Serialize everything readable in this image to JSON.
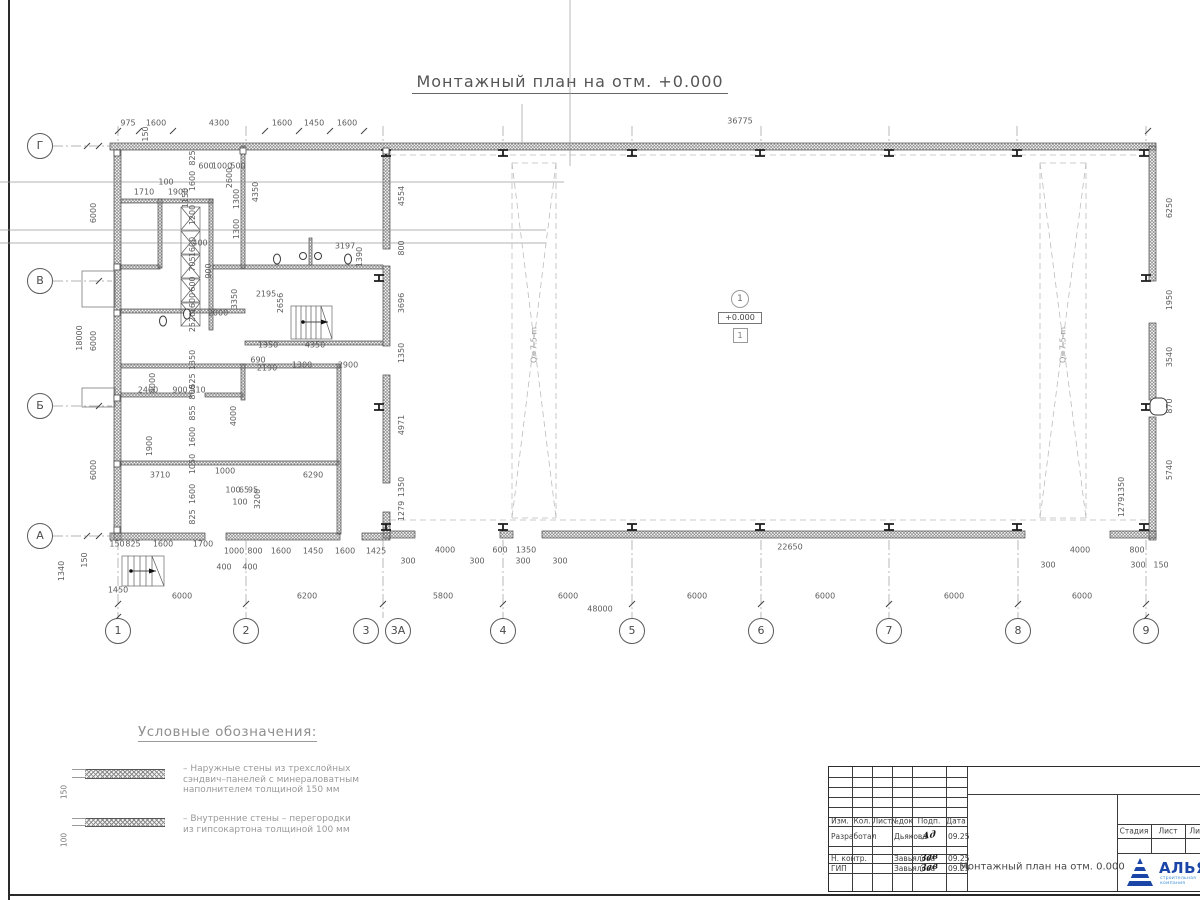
{
  "page": {
    "title": "Монтажный план на отм. +0.000"
  },
  "plan": {
    "axes_bottom": [
      {
        "label": "1",
        "x": 118
      },
      {
        "label": "2",
        "x": 246
      },
      {
        "label": "3",
        "x": 366
      },
      {
        "label": "3А",
        "x": 398
      },
      {
        "label": "4",
        "x": 503
      },
      {
        "label": "5",
        "x": 632
      },
      {
        "label": "6",
        "x": 761
      },
      {
        "label": "7",
        "x": 889
      },
      {
        "label": "8",
        "x": 1018
      },
      {
        "label": "9",
        "x": 1146
      }
    ],
    "axes_left": [
      {
        "label": "Г",
        "y": 146
      },
      {
        "label": "В",
        "y": 281
      },
      {
        "label": "Б",
        "y": 406
      },
      {
        "label": "А",
        "y": 536
      }
    ],
    "level_mark": {
      "axis_circle": "1",
      "elevation": "+0.000",
      "room_number": "1"
    },
    "crane_zones": [
      {
        "x": 534,
        "y": 345
      },
      {
        "x": 1063,
        "y": 345
      }
    ],
    "crane_label": "Q=7.5 m",
    "dims": [
      [
        "975",
        128,
        124
      ],
      [
        "1600",
        156,
        124
      ],
      [
        "4300",
        219,
        124
      ],
      [
        "1600",
        282,
        124
      ],
      [
        "1450",
        314,
        124
      ],
      [
        "1600",
        347,
        124
      ],
      [
        "36775",
        740,
        122
      ],
      [
        "150",
        146,
        134,
        1
      ],
      [
        "18000",
        80,
        338,
        1
      ],
      [
        "6000",
        94,
        213,
        1
      ],
      [
        "6000",
        94,
        341,
        1
      ],
      [
        "6000",
        94,
        470,
        1
      ],
      [
        "825",
        193,
        158,
        1
      ],
      [
        "1600",
        193,
        181,
        1
      ],
      [
        "1200",
        193,
        215,
        1
      ],
      [
        "1600",
        193,
        247,
        1
      ],
      [
        "705",
        193,
        264,
        1
      ],
      [
        "600",
        193,
        284,
        1
      ],
      [
        "1600",
        193,
        303,
        1
      ],
      [
        "2520",
        193,
        322,
        1
      ],
      [
        "1350",
        193,
        360,
        1
      ],
      [
        "525",
        193,
        381,
        1
      ],
      [
        "800",
        193,
        392,
        1
      ],
      [
        "855",
        193,
        413,
        1
      ],
      [
        "1600",
        193,
        437,
        1
      ],
      [
        "1050",
        193,
        464,
        1
      ],
      [
        "1600",
        193,
        494,
        1
      ],
      [
        "825",
        193,
        517,
        1
      ],
      [
        "2600",
        230,
        178,
        1
      ],
      [
        "100",
        166,
        183
      ],
      [
        "1710",
        144,
        193
      ],
      [
        "1900",
        178,
        193
      ],
      [
        "1150",
        186,
        198,
        1
      ],
      [
        "600",
        206,
        167
      ],
      [
        "1000",
        222,
        167
      ],
      [
        "500",
        238,
        167
      ],
      [
        "1300",
        237,
        199,
        1
      ],
      [
        "1300",
        237,
        229,
        1
      ],
      [
        "4350",
        256,
        192,
        1
      ],
      [
        "3197",
        345,
        247
      ],
      [
        "400",
        200,
        244
      ],
      [
        "900",
        209,
        271,
        1
      ],
      [
        "1390",
        360,
        257,
        1
      ],
      [
        "800",
        402,
        248,
        1
      ],
      [
        "4554",
        402,
        196,
        1
      ],
      [
        "2000",
        218,
        314
      ],
      [
        "3350",
        235,
        299,
        1
      ],
      [
        "2195",
        266,
        295
      ],
      [
        "2656",
        281,
        303,
        1
      ],
      [
        "3696",
        402,
        303,
        1
      ],
      [
        "1350",
        268,
        346
      ],
      [
        "4350",
        315,
        346
      ],
      [
        "690",
        258,
        361
      ],
      [
        "2190",
        267,
        369
      ],
      [
        "1300",
        302,
        366
      ],
      [
        "2900",
        348,
        366
      ],
      [
        "2400",
        148,
        391
      ],
      [
        "900",
        180,
        391
      ],
      [
        "510",
        198,
        391
      ],
      [
        "4000",
        153,
        383,
        1
      ],
      [
        "4000",
        234,
        416,
        1
      ],
      [
        "1900",
        150,
        446,
        1
      ],
      [
        "3710",
        160,
        476
      ],
      [
        "1000",
        225,
        472
      ],
      [
        "6290",
        313,
        476
      ],
      [
        "100",
        233,
        491
      ],
      [
        "65",
        244,
        491
      ],
      [
        "95",
        253,
        491
      ],
      [
        "100",
        240,
        503
      ],
      [
        "3200",
        258,
        499,
        1
      ],
      [
        "4971",
        402,
        425,
        1
      ],
      [
        "1350",
        402,
        353,
        1
      ],
      [
        "1350",
        402,
        487,
        1
      ],
      [
        "1279",
        402,
        511,
        1
      ],
      [
        "6250",
        1170,
        208,
        1
      ],
      [
        "1950",
        1170,
        300,
        1
      ],
      [
        "3540",
        1170,
        357,
        1
      ],
      [
        "870",
        1170,
        406,
        1
      ],
      [
        "5740",
        1170,
        470,
        1
      ],
      [
        "1350",
        1122,
        487,
        1
      ],
      [
        "1279",
        1122,
        507,
        1
      ],
      [
        "150",
        117,
        545
      ],
      [
        "825",
        133,
        545
      ],
      [
        "1600",
        163,
        545
      ],
      [
        "1700",
        203,
        545
      ],
      [
        "1000",
        234,
        552
      ],
      [
        "800",
        255,
        552
      ],
      [
        "1600",
        281,
        552
      ],
      [
        "1450",
        313,
        552
      ],
      [
        "1600",
        345,
        552
      ],
      [
        "1425",
        376,
        552
      ],
      [
        "400",
        224,
        568
      ],
      [
        "400",
        250,
        568
      ],
      [
        "4000",
        445,
        551
      ],
      [
        "600",
        500,
        551
      ],
      [
        "1350",
        526,
        551
      ],
      [
        "22650",
        790,
        548
      ],
      [
        "4000",
        1080,
        551
      ],
      [
        "800",
        1137,
        551
      ],
      [
        "300",
        408,
        562
      ],
      [
        "300",
        477,
        562
      ],
      [
        "300",
        523,
        562
      ],
      [
        "300",
        560,
        562
      ],
      [
        "300",
        1048,
        566
      ],
      [
        "300",
        1138,
        566
      ],
      [
        "150",
        1161,
        566
      ],
      [
        "6000",
        182,
        597
      ],
      [
        "6200",
        307,
        597
      ],
      [
        "5800",
        443,
        597
      ],
      [
        "6000",
        568,
        597
      ],
      [
        "6000",
        697,
        597
      ],
      [
        "6000",
        825,
        597
      ],
      [
        "6000",
        954,
        597
      ],
      [
        "6000",
        1082,
        597
      ],
      [
        "48000",
        600,
        610
      ],
      [
        "1340",
        62,
        571,
        1
      ],
      [
        "1450",
        118,
        591
      ],
      [
        "150",
        85,
        560,
        1
      ]
    ]
  },
  "geometry": {
    "walls": [
      [
        110,
        143,
        1046,
        7
      ],
      [
        114,
        150,
        7,
        390
      ],
      [
        1149,
        146,
        7,
        135
      ],
      [
        1149,
        323,
        7,
        77
      ],
      [
        1149,
        417,
        7,
        123
      ],
      [
        110,
        533,
        95,
        7
      ],
      [
        226,
        533,
        114,
        7
      ],
      [
        362,
        533,
        28,
        7
      ],
      [
        390,
        531,
        25,
        7
      ],
      [
        500,
        531,
        13,
        7
      ],
      [
        542,
        531,
        483,
        7
      ],
      [
        1110,
        531,
        46,
        7
      ],
      [
        383,
        150,
        7,
        99
      ],
      [
        383,
        266,
        7,
        80
      ],
      [
        383,
        375,
        7,
        108
      ],
      [
        383,
        512,
        7,
        26
      ],
      [
        121,
        199,
        92,
        4
      ],
      [
        121,
        265,
        39,
        4
      ],
      [
        213,
        265,
        170,
        4
      ],
      [
        121,
        309,
        124,
        4
      ],
      [
        245,
        341,
        138,
        4
      ],
      [
        121,
        364,
        220,
        4
      ],
      [
        121,
        393,
        70,
        4
      ],
      [
        205,
        393,
        38,
        4
      ],
      [
        121,
        461,
        218,
        4
      ],
      [
        158,
        199,
        4,
        69
      ],
      [
        209,
        199,
        4,
        131
      ],
      [
        241,
        146,
        4,
        122
      ],
      [
        241,
        364,
        4,
        36
      ],
      [
        337,
        364,
        4,
        170
      ],
      [
        309,
        238,
        3,
        27
      ]
    ],
    "boxes": [
      [
        82,
        271,
        33,
        36
      ],
      [
        82,
        388,
        33,
        19
      ],
      [
        291,
        306,
        41,
        33
      ],
      [
        122,
        556,
        42,
        30
      ]
    ],
    "xboxes": [
      [
        181,
        207,
        19,
        23
      ],
      [
        181,
        231,
        19,
        23
      ],
      [
        181,
        255,
        19,
        23
      ],
      [
        181,
        279,
        19,
        23
      ],
      [
        181,
        303,
        19,
        23
      ]
    ],
    "crane_zones": [
      [
        512,
        163,
        44,
        355
      ],
      [
        1040,
        163,
        46,
        355
      ]
    ],
    "lines": [
      [
        110,
        131,
        1156,
        131,
        "dim"
      ],
      [
        87,
        146,
        87,
        536,
        "dim"
      ],
      [
        99,
        146,
        99,
        536,
        "dim"
      ],
      [
        197,
        140,
        197,
        560,
        "dim"
      ],
      [
        402,
        150,
        402,
        530,
        "dim"
      ],
      [
        1170,
        146,
        1170,
        540,
        "dim"
      ],
      [
        1122,
        478,
        1122,
        516,
        "dim"
      ],
      [
        110,
        550,
        388,
        550,
        "dim"
      ],
      [
        390,
        556,
        1164,
        556,
        "dim"
      ],
      [
        118,
        604,
        1146,
        604,
        "dim"
      ],
      [
        118,
        617,
        1146,
        617,
        "dim"
      ],
      [
        53,
        146,
        112,
        146,
        "dashdot"
      ],
      [
        53,
        281,
        112,
        281,
        "dashdot"
      ],
      [
        53,
        406,
        112,
        406,
        "dashdot"
      ],
      [
        53,
        536,
        112,
        536,
        "dashdot"
      ],
      [
        118,
        540,
        118,
        618,
        "dashdot"
      ],
      [
        246,
        540,
        246,
        618,
        "dashdot"
      ],
      [
        383,
        540,
        383,
        618,
        "dashdot"
      ],
      [
        503,
        540,
        503,
        618,
        "dashdot"
      ],
      [
        632,
        540,
        632,
        618,
        "dashdot"
      ],
      [
        761,
        540,
        761,
        618,
        "dashdot"
      ],
      [
        889,
        540,
        889,
        618,
        "dashdot"
      ],
      [
        1018,
        540,
        1018,
        618,
        "dashdot"
      ],
      [
        1146,
        540,
        1146,
        618,
        "dashdot"
      ],
      [
        118,
        126,
        118,
        146,
        "dashdot"
      ],
      [
        246,
        126,
        246,
        146,
        "dashdot"
      ],
      [
        383,
        126,
        383,
        146,
        "dashdot"
      ],
      [
        503,
        126,
        503,
        146,
        "dashdot"
      ],
      [
        632,
        126,
        632,
        146,
        "dashdot"
      ],
      [
        761,
        126,
        761,
        146,
        "dashdot"
      ],
      [
        889,
        126,
        889,
        146,
        "dashdot"
      ],
      [
        1017,
        126,
        1017,
        146,
        "dashdot"
      ],
      [
        1146,
        126,
        1146,
        146,
        "dashdot"
      ],
      [
        366,
        618,
        380,
        606,
        "dim"
      ],
      [
        398,
        618,
        386,
        606,
        "dim"
      ],
      [
        390,
        155,
        1148,
        155,
        "dash"
      ],
      [
        390,
        520,
        1148,
        520,
        "dash"
      ],
      [
        296,
        306,
        296,
        339,
        "thin"
      ],
      [
        301,
        306,
        301,
        339,
        "thin"
      ],
      [
        306,
        306,
        306,
        339,
        "thin"
      ],
      [
        311,
        306,
        311,
        339,
        "thin"
      ],
      [
        316,
        306,
        316,
        339,
        "thin"
      ],
      [
        321,
        306,
        321,
        339,
        "thin"
      ],
      [
        321,
        306,
        332,
        339,
        "thin"
      ],
      [
        128,
        556,
        128,
        586,
        "thin"
      ],
      [
        134,
        556,
        134,
        586,
        "thin"
      ],
      [
        140,
        556,
        140,
        586,
        "thin"
      ],
      [
        146,
        556,
        146,
        586,
        "thin"
      ],
      [
        152,
        556,
        152,
        586,
        "thin"
      ],
      [
        152,
        556,
        164,
        586,
        "thin"
      ]
    ],
    "ticks": [
      [
        118,
        131
      ],
      [
        139,
        131
      ],
      [
        173,
        131
      ],
      [
        265,
        131
      ],
      [
        299,
        131
      ],
      [
        330,
        131
      ],
      [
        364,
        131
      ],
      [
        1148,
        131
      ],
      [
        118,
        604
      ],
      [
        246,
        604
      ],
      [
        383,
        604
      ],
      [
        503,
        604
      ],
      [
        632,
        604
      ],
      [
        761,
        604
      ],
      [
        889,
        604
      ],
      [
        1018,
        604
      ],
      [
        1146,
        604
      ],
      [
        118,
        617
      ],
      [
        1146,
        617
      ],
      [
        87,
        146
      ],
      [
        87,
        536
      ],
      [
        99,
        146
      ],
      [
        99,
        281
      ],
      [
        99,
        406
      ],
      [
        99,
        536
      ]
    ],
    "beams": [
      [
        386,
        153
      ],
      [
        503,
        153
      ],
      [
        632,
        153
      ],
      [
        760,
        153
      ],
      [
        889,
        153
      ],
      [
        1017,
        153
      ],
      [
        1144,
        153
      ],
      [
        386,
        527
      ],
      [
        503,
        527
      ],
      [
        632,
        527
      ],
      [
        760,
        527
      ],
      [
        889,
        527
      ],
      [
        1017,
        527
      ],
      [
        1144,
        527
      ],
      [
        379,
        278
      ],
      [
        379,
        407
      ],
      [
        1146,
        278
      ],
      [
        1146,
        407
      ]
    ],
    "squares": [
      [
        117,
        153
      ],
      [
        117,
        267
      ],
      [
        117,
        313
      ],
      [
        117,
        398
      ],
      [
        117,
        464
      ],
      [
        117,
        530
      ],
      [
        243,
        151
      ],
      [
        386,
        151
      ]
    ],
    "wc": [
      [
        277,
        259
      ],
      [
        348,
        259
      ],
      [
        163,
        321
      ],
      [
        187,
        314
      ]
    ],
    "sinks": [
      [
        303,
        256
      ],
      [
        318,
        256
      ]
    ],
    "door": [
      1150,
      398,
      17,
      17
    ],
    "arrows": [
      [
        303,
        322,
        328,
        322
      ],
      [
        131,
        571,
        156,
        571
      ]
    ]
  },
  "legend": {
    "heading": "Условные обозначения:",
    "items": [
      {
        "thickness": "150",
        "text": "– Наружные стены из трехслойных\nсэндвич–панелей с минераловатным\nнаполнителем толщиной 150 мм"
      },
      {
        "thickness": "100",
        "text": "– Внутренние стены – перегородки\nиз гипсокартона толщиной 100 мм"
      }
    ]
  },
  "titleblock": {
    "headers": [
      "Изм.",
      "Кол.",
      "Лист",
      "№док",
      "Подп.",
      "Дата"
    ],
    "rows": [
      {
        "role": "Разработал",
        "name": "Дьякова",
        "sign": "Ад",
        "date": "09.25"
      },
      {
        "role": "Н. контр.",
        "name": "Завьялова",
        "sign": "Зав",
        "date": "09.25"
      },
      {
        "role": "ГИП",
        "name": "Завьялова",
        "sign": "Зав",
        "date": "09.25"
      }
    ],
    "doc_title": "Монтажный план на отм. 0.000",
    "stage_headers": [
      "Стадия",
      "Лист",
      "Лист"
    ],
    "logo": {
      "name": "АЛЬЯНС",
      "subtitle": "строительная компания",
      "color": "#1b46a8",
      "subtitle_color": "#4090d8"
    }
  }
}
